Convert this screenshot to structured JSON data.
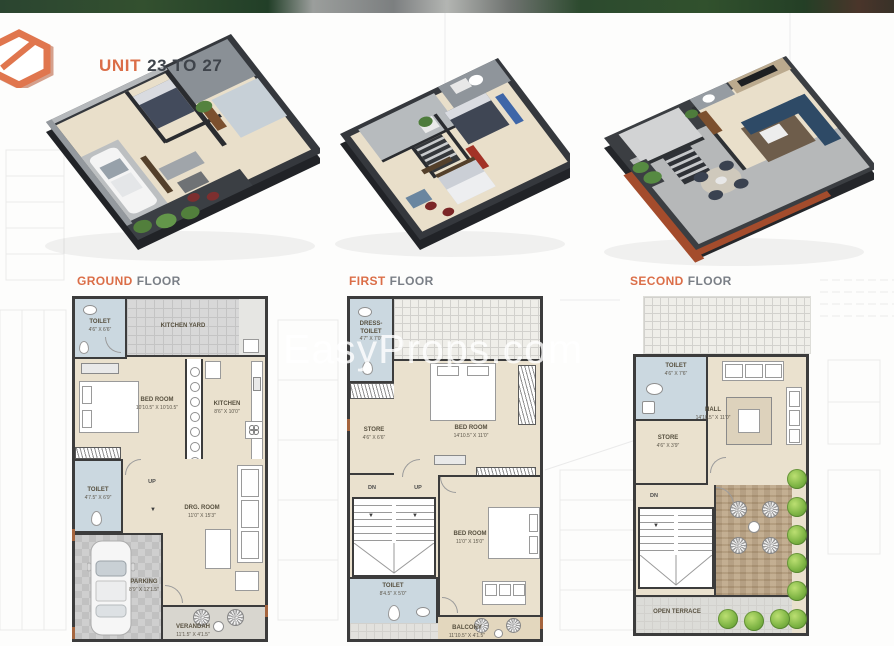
{
  "header": {
    "title_accent": "UNIT",
    "title_rest": "23 TO 27"
  },
  "watermark": "EasyProps.com",
  "glyphs": {
    "down_arrow": "▼"
  },
  "colors": {
    "accent_orange": "#DB6E48",
    "title_dark": "#3F444B",
    "wall_dark": "#3C3C3C",
    "floor_beige": "#EAE1CE",
    "wet_blue": "#CBD8E0",
    "plant_green": "#7FB545"
  },
  "floors": [
    {
      "label_accent": "GROUND",
      "label_rest": "FLOOR",
      "rooms": {
        "toilet_top": {
          "name": "TOILET",
          "dims": "4'6\" X 6'6\""
        },
        "kitchen_yard": {
          "name": "KITCHEN YARD"
        },
        "bed_room": {
          "name": "BED ROOM",
          "dims": "10'10.5\" X 10'10.5\""
        },
        "kitchen": {
          "name": "KITCHEN",
          "dims": "8'6\" X 10'0\""
        },
        "toilet_mid": {
          "name": "TOILET",
          "dims": "4'7.5\" X 6'9\""
        },
        "stairs_up": {
          "name": "UP"
        },
        "drg_room": {
          "name": "DRG. ROOM",
          "dims": "11'0\" X 15'3\""
        },
        "parking": {
          "name": "PARKING",
          "dims": "8'9\" X 12'1.5\""
        },
        "verandah": {
          "name": "VERANDAH",
          "dims": "11'1.5\" X 4'1.5\""
        }
      }
    },
    {
      "label_accent": "FIRST",
      "label_rest": "FLOOR",
      "rooms": {
        "dress_toilet": {
          "name": "DRESS- TOILET",
          "dims": "4'7\" X 7'0\""
        },
        "store": {
          "name": "STORE",
          "dims": "4'6\" X 6'6\""
        },
        "bed_room_top": {
          "name": "BED ROOM",
          "dims": "14'10.5\" X 11'0\""
        },
        "stairs_dn": {
          "name": "DN"
        },
        "stairs_up": {
          "name": "UP"
        },
        "bed_room_bottom": {
          "name": "BED ROOM",
          "dims": "11'0\" X 15'0\""
        },
        "toilet": {
          "name": "TOILET",
          "dims": "8'4.5\" X 5'0\""
        },
        "balcony": {
          "name": "BALCONY",
          "dims": "11'10.5\" X 4'1.5\""
        }
      }
    },
    {
      "label_accent": "SECOND",
      "label_rest": "FLOOR",
      "rooms": {
        "toilet": {
          "name": "TOILET",
          "dims": "4'6\" X 7'6\""
        },
        "hall": {
          "name": "HALL",
          "dims": "14'10.5\" X 11'0\""
        },
        "store": {
          "name": "STORE",
          "dims": "4'6\" X 3'9\""
        },
        "stairs_dn": {
          "name": "DN"
        },
        "open_terrace": {
          "name": "OPEN TERRACE"
        }
      }
    }
  ]
}
